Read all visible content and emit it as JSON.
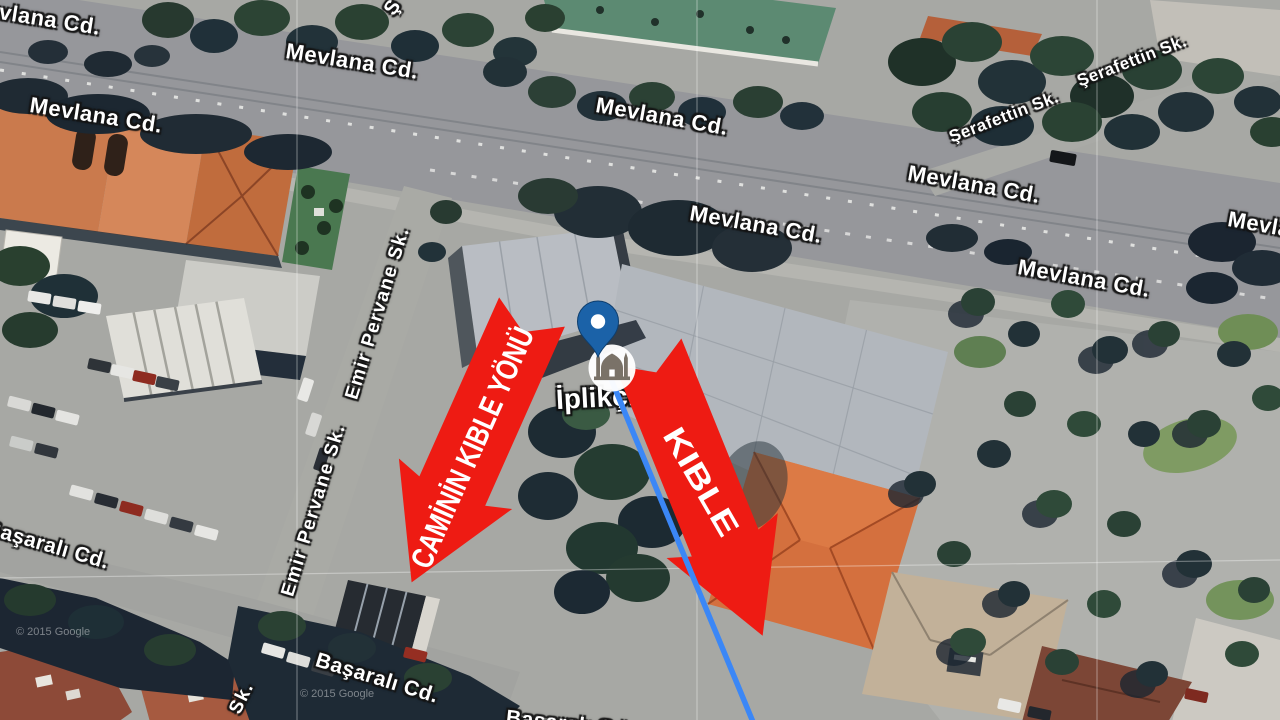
{
  "map": {
    "poi_label": "İplikçi",
    "poi_icon": "mosque-icon",
    "street_labels": [
      {
        "text": "Mevlana Cd.",
        "x": -32,
        "y": -6,
        "rot": 9,
        "size": 22,
        "vertical": false
      },
      {
        "text": "Mevlana Cd.",
        "x": 286,
        "y": 38,
        "rot": 9,
        "size": 22,
        "vertical": false
      },
      {
        "text": "Mevlana Cd.",
        "x": 30,
        "y": 92,
        "rot": 9,
        "size": 22,
        "vertical": false
      },
      {
        "text": "Mevlana Cd.",
        "x": 596,
        "y": 92,
        "rot": 10,
        "size": 22,
        "vertical": false
      },
      {
        "text": "Mevlana Cd.",
        "x": 690,
        "y": 200,
        "rot": 10,
        "size": 22,
        "vertical": false
      },
      {
        "text": "Mevlana Cd.",
        "x": 908,
        "y": 160,
        "rot": 10,
        "size": 22,
        "vertical": false
      },
      {
        "text": "Mevlana Cd.",
        "x": 1018,
        "y": 254,
        "rot": 10,
        "size": 22,
        "vertical": false
      },
      {
        "text": "Mevlana Cd.",
        "x": 1228,
        "y": 206,
        "rot": 10,
        "size": 22,
        "vertical": false
      },
      {
        "text": "Şerafettin Sk.",
        "x": 950,
        "y": 128,
        "rot": -21,
        "size": 17,
        "vertical": false
      },
      {
        "text": "Şerafettin Sk.",
        "x": 1078,
        "y": 72,
        "rot": -21,
        "size": 17,
        "vertical": false
      },
      {
        "text": "Emir Pervane Sk.",
        "x": 352,
        "y": 388,
        "rot": -73,
        "size": 19,
        "vertical": true
      },
      {
        "text": "Emir Pervane Sk.",
        "x": 288,
        "y": 585,
        "rot": -73,
        "size": 19,
        "vertical": true
      },
      {
        "text": "Başaralı Cd.",
        "x": -14,
        "y": 516,
        "rot": 16,
        "size": 21,
        "vertical": false
      },
      {
        "text": "Başaralı Cd.",
        "x": 316,
        "y": 648,
        "rot": 17,
        "size": 21,
        "vertical": false
      },
      {
        "text": "Başaralı Cd.",
        "x": 506,
        "y": 706,
        "rot": 6,
        "size": 21,
        "vertical": false
      },
      {
        "text": "Sk.",
        "x": 235,
        "y": 702,
        "rot": -64,
        "size": 19,
        "vertical": true
      },
      {
        "text": "Ş",
        "x": 389,
        "y": 2,
        "rot": -55,
        "size": 20,
        "vertical": true
      }
    ],
    "watermarks": [
      {
        "text": "© 2015 Google",
        "x": 16,
        "y": 626
      },
      {
        "text": "© 2015 Google",
        "x": 300,
        "y": 688
      }
    ]
  },
  "annotations": {
    "arrow_left": {
      "label": "CAMİNİN KIBLE YÖNÜ"
    },
    "arrow_right": {
      "label": "KIBLE"
    },
    "arrow_color": "#ee1b13",
    "qibla_line_color": "#3b87f6",
    "pin_color": "#1b62a8"
  }
}
